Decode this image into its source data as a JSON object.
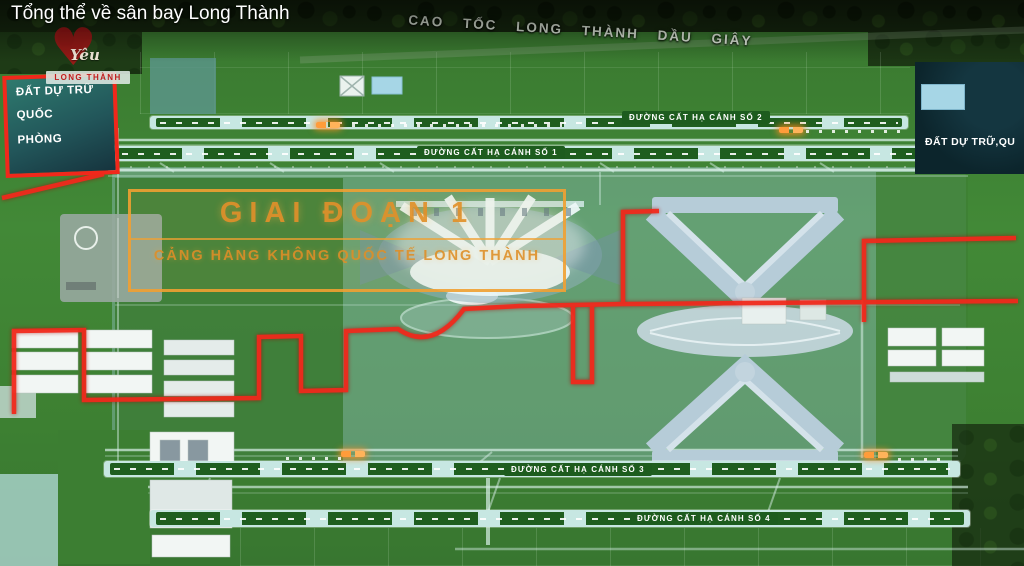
{
  "video": {
    "title": "Tổng thể về sân bay Long Thành"
  },
  "watermark": {
    "heart_icon": "♥",
    "script_text": "Yêu",
    "banner_text": "LONG THÀNH"
  },
  "map": {
    "highway_label": "CAO TỐC LONG THÀNH DẦU GIÂY",
    "left_reserve": {
      "line1": "ĐẤT DỰ TRỮ",
      "line2": "QUỐC",
      "line3": "PHÒNG"
    },
    "right_reserve": {
      "label": "ĐẤT DỰ TRỮ,QU"
    },
    "phase_box": {
      "title": "GIAI ĐOẠN 1",
      "subtitle": "CẢNG HÀNG KHÔNG QUỐC TẾ LONG THÀNH"
    },
    "runways": [
      {
        "label": "ĐƯỜNG CẤT HẠ CÁNH SỐ 1"
      },
      {
        "label": "ĐƯỜNG CẤT HẠ CÁNH SỐ 2"
      },
      {
        "label": "ĐƯỜNG CẤT HẠ CÁNH SỐ 3"
      },
      {
        "label": "ĐƯỜNG CẤT HẠ CÁNH SỐ 4"
      }
    ],
    "colors": {
      "boundary_red": "#f1281b",
      "phase_orange": "#eb9832",
      "runway_cyan": "#c7e7e2",
      "field_green": "#3f8035",
      "reserve_teal": "#2e7a6e"
    }
  }
}
